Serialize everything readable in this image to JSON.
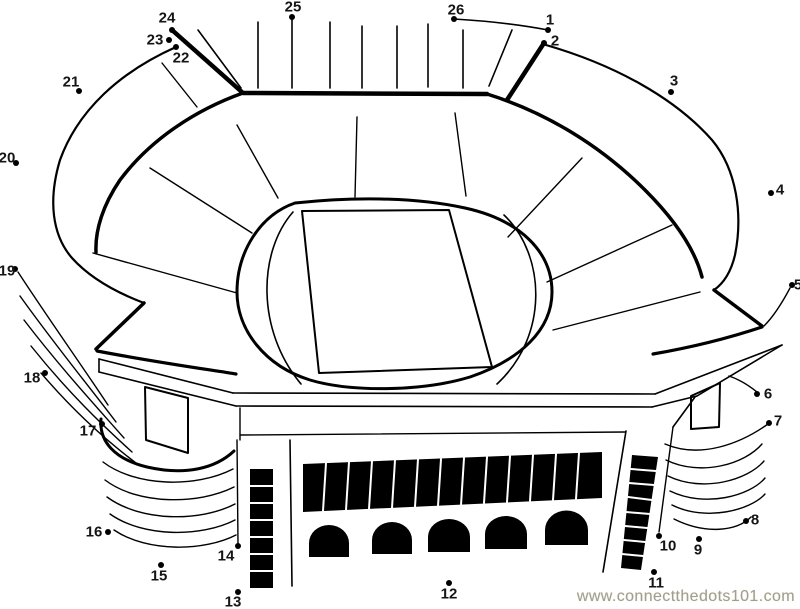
{
  "page": {
    "background": "#ffffff",
    "line_color": "#000000"
  },
  "watermark": {
    "text": "www.connectthedots101.com",
    "color": "#a09e94"
  },
  "puzzle": {
    "subject": "stadium connect-the-dots line art",
    "dot_count": 26,
    "dot_color": "#000000",
    "dots": [
      {
        "n": "1",
        "x": 548,
        "y": 30,
        "lx": 550,
        "ly": 20
      },
      {
        "n": "2",
        "x": 544,
        "y": 43,
        "lx": 555,
        "ly": 41
      },
      {
        "n": "3",
        "x": 671,
        "y": 92,
        "lx": 674,
        "ly": 81
      },
      {
        "n": "4",
        "x": 771,
        "y": 193,
        "lx": 780,
        "ly": 190
      },
      {
        "n": "5",
        "x": 792,
        "y": 285,
        "lx": 798,
        "ly": 285
      },
      {
        "n": "6",
        "x": 757,
        "y": 394,
        "lx": 768,
        "ly": 394
      },
      {
        "n": "7",
        "x": 769,
        "y": 423,
        "lx": 778,
        "ly": 421
      },
      {
        "n": "8",
        "x": 746,
        "y": 521,
        "lx": 755,
        "ly": 520
      },
      {
        "n": "9",
        "x": 699,
        "y": 539,
        "lx": 698,
        "ly": 550
      },
      {
        "n": "10",
        "x": 659,
        "y": 536,
        "lx": 668,
        "ly": 546
      },
      {
        "n": "11",
        "x": 654,
        "y": 572,
        "lx": 656,
        "ly": 583
      },
      {
        "n": "12",
        "x": 449,
        "y": 583,
        "lx": 449,
        "ly": 594
      },
      {
        "n": "13",
        "x": 238,
        "y": 592,
        "lx": 233,
        "ly": 602
      },
      {
        "n": "14",
        "x": 238,
        "y": 546,
        "lx": 226,
        "ly": 556
      },
      {
        "n": "15",
        "x": 161,
        "y": 565,
        "lx": 159,
        "ly": 576
      },
      {
        "n": "16",
        "x": 108,
        "y": 532,
        "lx": 94,
        "ly": 532
      },
      {
        "n": "17",
        "x": 102,
        "y": 424,
        "lx": 88,
        "ly": 431
      },
      {
        "n": "18",
        "x": 45,
        "y": 373,
        "lx": 32,
        "ly": 378
      },
      {
        "n": "19",
        "x": 15,
        "y": 269,
        "lx": 7,
        "ly": 271
      },
      {
        "n": "20",
        "x": 16,
        "y": 163,
        "lx": 7,
        "ly": 158
      },
      {
        "n": "21",
        "x": 79,
        "y": 91,
        "lx": 71,
        "ly": 82
      },
      {
        "n": "22",
        "x": 176,
        "y": 47,
        "lx": 181,
        "ly": 58
      },
      {
        "n": "23",
        "x": 169,
        "y": 40,
        "lx": 155,
        "ly": 40
      },
      {
        "n": "24",
        "x": 172,
        "y": 30,
        "lx": 167,
        "ly": 18
      },
      {
        "n": "25",
        "x": 292,
        "y": 17,
        "lx": 293,
        "ly": 7
      },
      {
        "n": "26",
        "x": 454,
        "y": 19,
        "lx": 456,
        "ly": 10
      }
    ]
  }
}
